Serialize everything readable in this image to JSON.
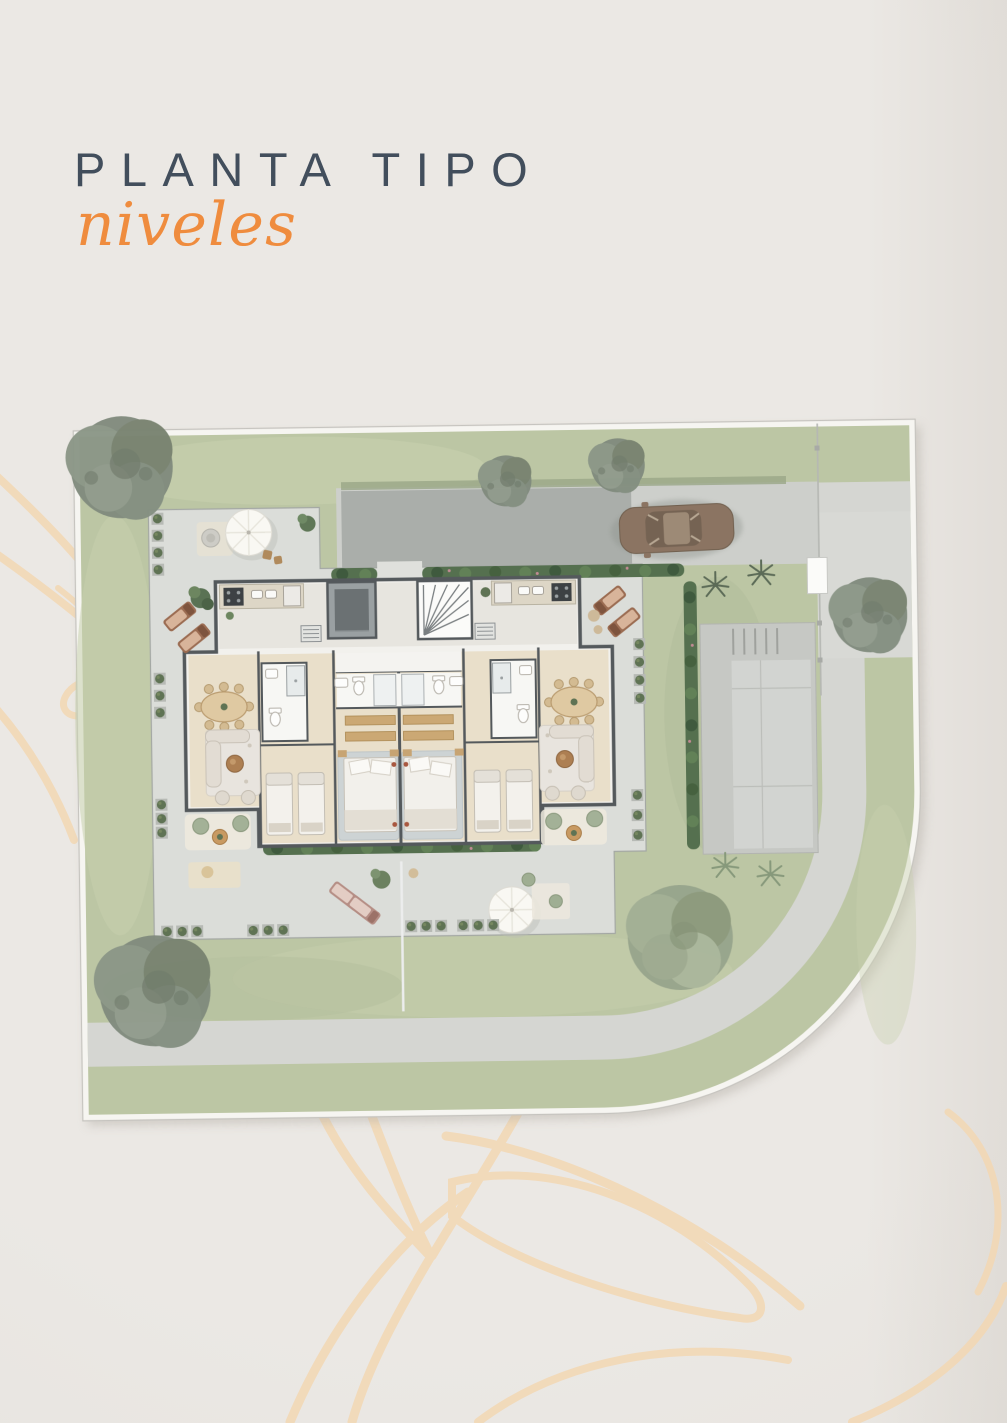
{
  "header": {
    "title": "PLANTA TIPO",
    "subtitle": "niveles"
  },
  "colors": {
    "background": "#eae7e3",
    "title_text": "#424e5c",
    "accent_orange": "#ef8c3e",
    "decorative_line": "#f3d7b3",
    "lawn": "#bcc6a4",
    "walkway": "#d5d6d2",
    "terrace": "#dbddd9",
    "road": "#cdcfcb",
    "road_dark_pad": "#a7aba7",
    "concrete_pad": "#c6c8c4",
    "curb": "#f6f5f1",
    "building_wall": "#54595c",
    "room_floor": "#e9dfca",
    "wood_furniture": "#c7a473",
    "hedge_green": "#4f6749",
    "tree_gray": "#7f8a7c",
    "tree_sage": "#93a089",
    "car_bronze": "#8b7462",
    "master_rug": "#cbd2d5"
  },
  "site_plan": {
    "description": "Top-down rendered site plan of a typical residential level on a corner lot with a curved street",
    "building": {
      "apartment_units": 2,
      "layout": "two mirrored apartments around a central core",
      "rooms_per_unit": [
        "kitchen",
        "dining area",
        "living room",
        "bathroom",
        "bedroom with two single beds",
        "master bedroom with ensuite"
      ],
      "core": [
        "elevator",
        "staircase"
      ]
    },
    "landscape": {
      "canopy_trees": 6,
      "palm_plants": 4,
      "hedges": [
        "street hedge",
        "top terrace hedge",
        "right terrace hedge",
        "bottom planting bed"
      ],
      "planter_boxes": 12
    },
    "amenities": {
      "patio_umbrellas": 2,
      "sun_loungers": 6,
      "outdoor_pouf_seats": 6,
      "outdoor_dining_patio": 1
    },
    "street": {
      "curved_sidewalk": true,
      "parked_cars": 1,
      "driveway": true
    }
  }
}
